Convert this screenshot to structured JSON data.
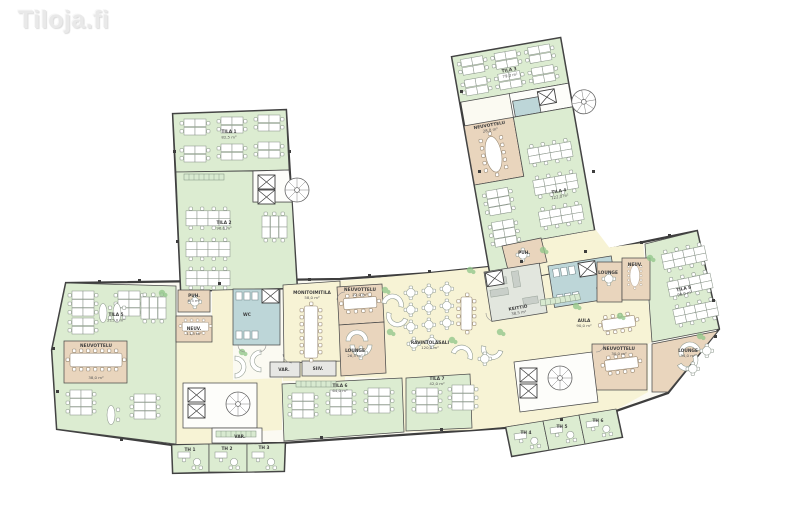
{
  "logo": {
    "text": "Tiloja.fi"
  },
  "colors": {
    "footprint": "#fbfaf2",
    "office": "#dcecd1",
    "meeting": "#e9d5bd",
    "wc": "#bdd6d8",
    "corridor": "#f7f3d5",
    "storage": "#e7e7e4",
    "kitchen": "#e2e6de",
    "wall": "#3e3e3e",
    "plant": "#93c78b",
    "plantlight": "#d8ead0",
    "logo": "#e9e9e9"
  },
  "rooms": [
    {
      "id": "wing1-office-top",
      "label": "TILA 1",
      "area": "82,5 m²"
    },
    {
      "id": "wing1-office-low",
      "label": "TILA 2",
      "area": "96,0 m²"
    },
    {
      "id": "wing2-office-top",
      "label": "TILA 3",
      "area": "79,0 m²"
    },
    {
      "id": "wing2-meeting",
      "label": "NEUVOTTELU",
      "area": "28,0 m²"
    },
    {
      "id": "wing2-office-low",
      "label": "TILA 4",
      "area": "122,0 m²"
    },
    {
      "id": "left-office",
      "label": "TILA 5",
      "area": "215,0 m²"
    },
    {
      "id": "left-meeting",
      "label": "NEUVOTTELU",
      "area": "38,0 m²"
    },
    {
      "id": "small-meeting",
      "label": "NEUV.",
      "area": "11,5 m²"
    },
    {
      "id": "phone-room",
      "label": "PUH.",
      "area": "6,5 m²"
    },
    {
      "id": "wc-left",
      "label": "WC",
      "area": ""
    },
    {
      "id": "multipurpose",
      "label": "MONITOIMITILA",
      "area": "58,0 m²"
    },
    {
      "id": "center-meeting",
      "label": "NEUVOTTELU",
      "area": "22,0 m²"
    },
    {
      "id": "center-lounge",
      "label": "LOUNGE",
      "area": "26,5 m²"
    },
    {
      "id": "restaurant",
      "label": "RAVINTOLASALI",
      "area": "120,0 m²"
    },
    {
      "id": "kitchen",
      "label": "KEITTIÖ",
      "area": "38,5 m²"
    },
    {
      "id": "wc-right",
      "label": "WC",
      "area": ""
    },
    {
      "id": "lobby",
      "label": "AULA",
      "area": "90,0 m²"
    },
    {
      "id": "bottom-office-1",
      "label": "TILA 6",
      "area": "64,0 m²"
    },
    {
      "id": "bottom-office-2",
      "label": "TILA 7",
      "area": "42,0 m²"
    },
    {
      "id": "right-office",
      "label": "TILA 8",
      "area": "98,0 m²"
    },
    {
      "id": "right-lounge-small",
      "label": "LOUNGE",
      "area": ""
    },
    {
      "id": "right-meeting-small",
      "label": "NEUV.",
      "area": ""
    },
    {
      "id": "right-meeting",
      "label": "NEUVOTTELU",
      "area": "30,0 m²"
    },
    {
      "id": "right-lounge",
      "label": "LOUNGE",
      "area": "34,0 m²"
    },
    {
      "id": "storage-1",
      "label": "VAR.",
      "area": ""
    },
    {
      "id": "storage-2",
      "label": "SIIV.",
      "area": ""
    },
    {
      "id": "office-th1",
      "label": "TH 1",
      "area": ""
    },
    {
      "id": "office-th2",
      "label": "TH 2",
      "area": ""
    },
    {
      "id": "office-th3",
      "label": "TH 3",
      "area": ""
    },
    {
      "id": "office-th4",
      "label": "TH 4",
      "area": ""
    },
    {
      "id": "office-th5",
      "label": "TH 5",
      "area": ""
    },
    {
      "id": "office-th6",
      "label": "TH 6",
      "area": ""
    },
    {
      "id": "junction-phone",
      "label": "PUH.",
      "area": ""
    },
    {
      "id": "storage-3",
      "label": "VAR.",
      "area": ""
    }
  ]
}
